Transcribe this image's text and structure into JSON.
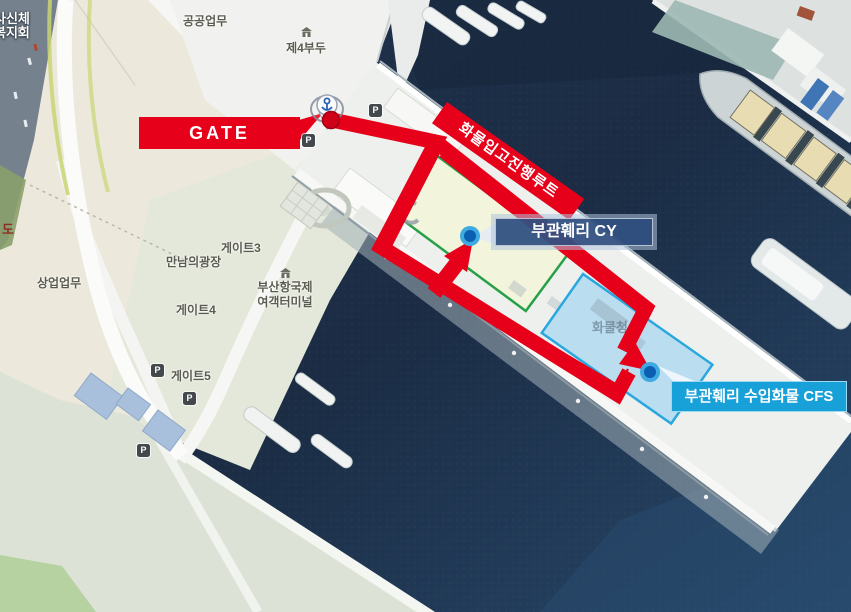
{
  "callouts": {
    "gate": "GATE",
    "route_banner": "화물입고진행루트",
    "cy": "부관훼리 CY",
    "cfs": "부관훼리 수입화물 CFS"
  },
  "map_labels": {
    "public_zone": "공공업무",
    "pier4": "제4부두",
    "commercial_zone": "상업업무",
    "gate3": "게이트3",
    "meeting_plaza": "만남의광장",
    "terminal_line1": "부산항국제",
    "terminal_line2": "여객터미널",
    "gate4": "게이트4",
    "gate5": "게이트5",
    "corner_line1": "사신체",
    "corner_line2": "복지회",
    "road_fragment": "도",
    "cargo_area_faint": "화물청사"
  },
  "icons": {
    "parking": "P"
  },
  "colors": {
    "route_red": "#e60019",
    "zone_green_border": "#27a048",
    "zone_blue_border": "#2aa7de",
    "cy_box_fill": "#2f4f86",
    "cfs_box_fill": "#18a0d8",
    "water": "#1d3350"
  }
}
